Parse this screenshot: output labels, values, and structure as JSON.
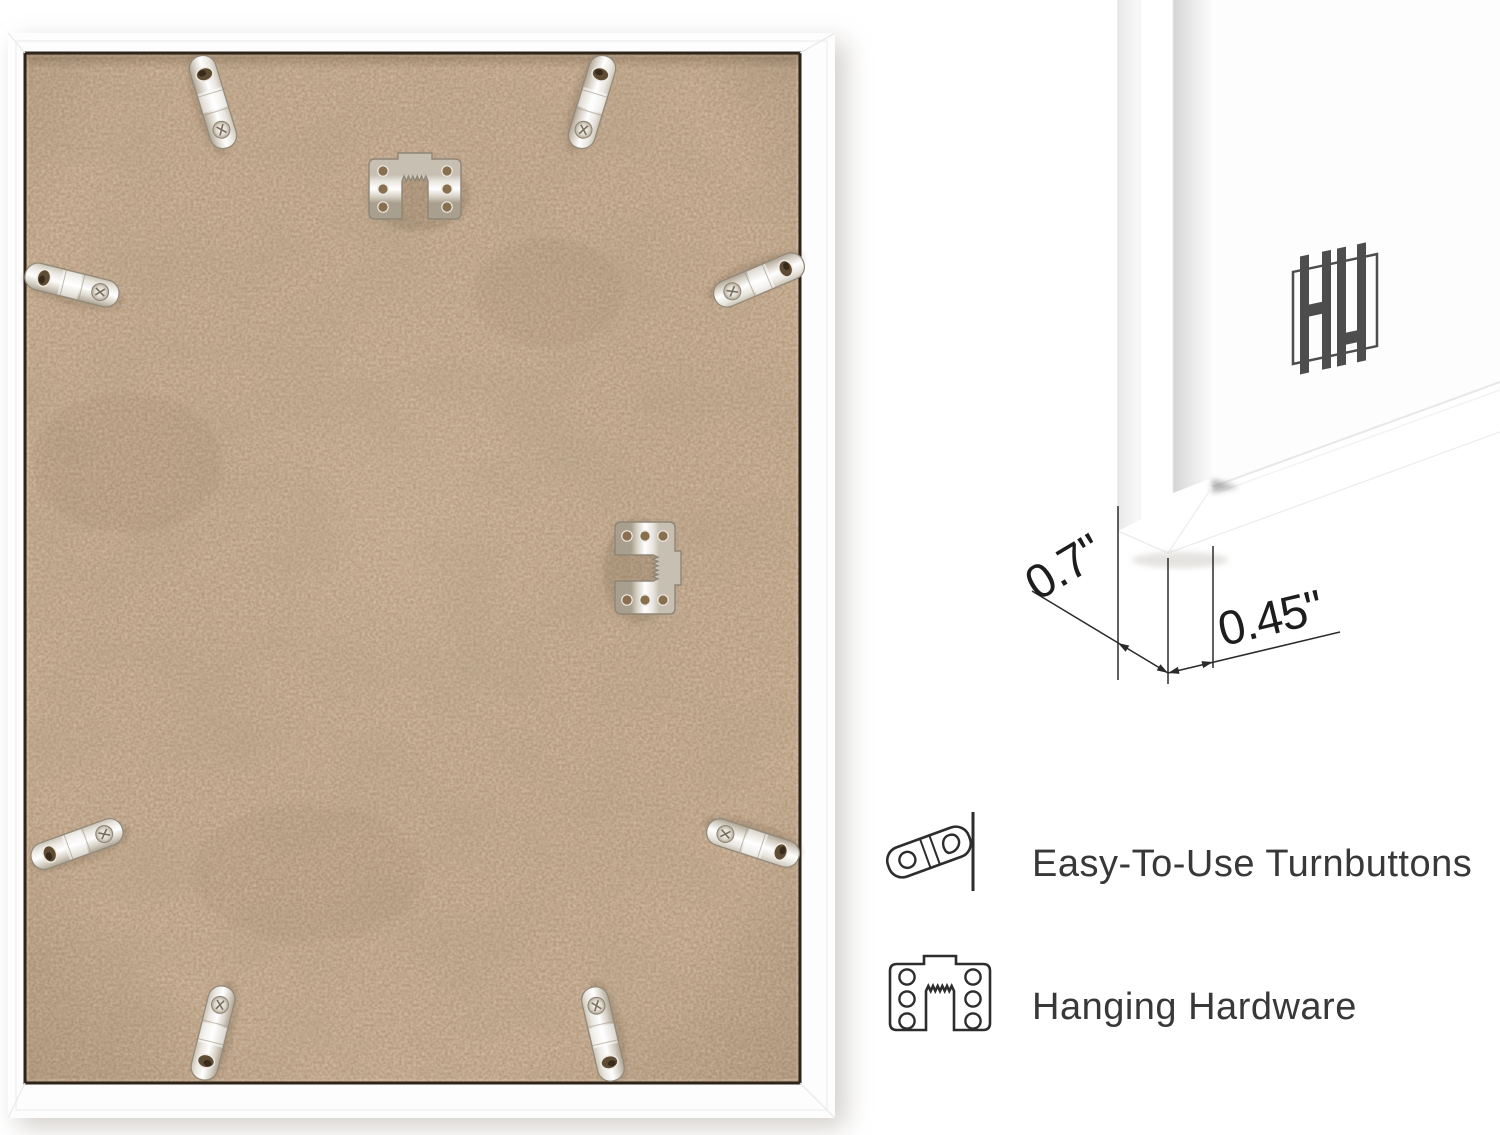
{
  "image": {
    "type": "product-infographic",
    "alt": "Back of white picture frame with hardware, corner close-up with dimensions, feature callouts"
  },
  "dimensions": {
    "depth": "0.7\"",
    "face_width": "0.45\""
  },
  "features": [
    {
      "icon": "turnbutton-icon",
      "label": "Easy-To-Use Turnbuttons"
    },
    {
      "icon": "hanging-hardware-icon",
      "label": "Hanging Hardware"
    }
  ],
  "logo": {
    "name": "double-h-monogram"
  },
  "hardware": {
    "turnbutton_count": 8,
    "sawtooth_hanger_count": 2
  },
  "colors": {
    "background": "#ffffff",
    "mdf": "#c2a284",
    "mdf_gap": "#2e2419",
    "metal": "#d8d2c7",
    "frame_white": "#fdfdfd",
    "label_text": "#383838",
    "dimension_text": "#1d1d1d",
    "logo": "#4d4d4d",
    "icon_outline": "#2d2d2d"
  }
}
